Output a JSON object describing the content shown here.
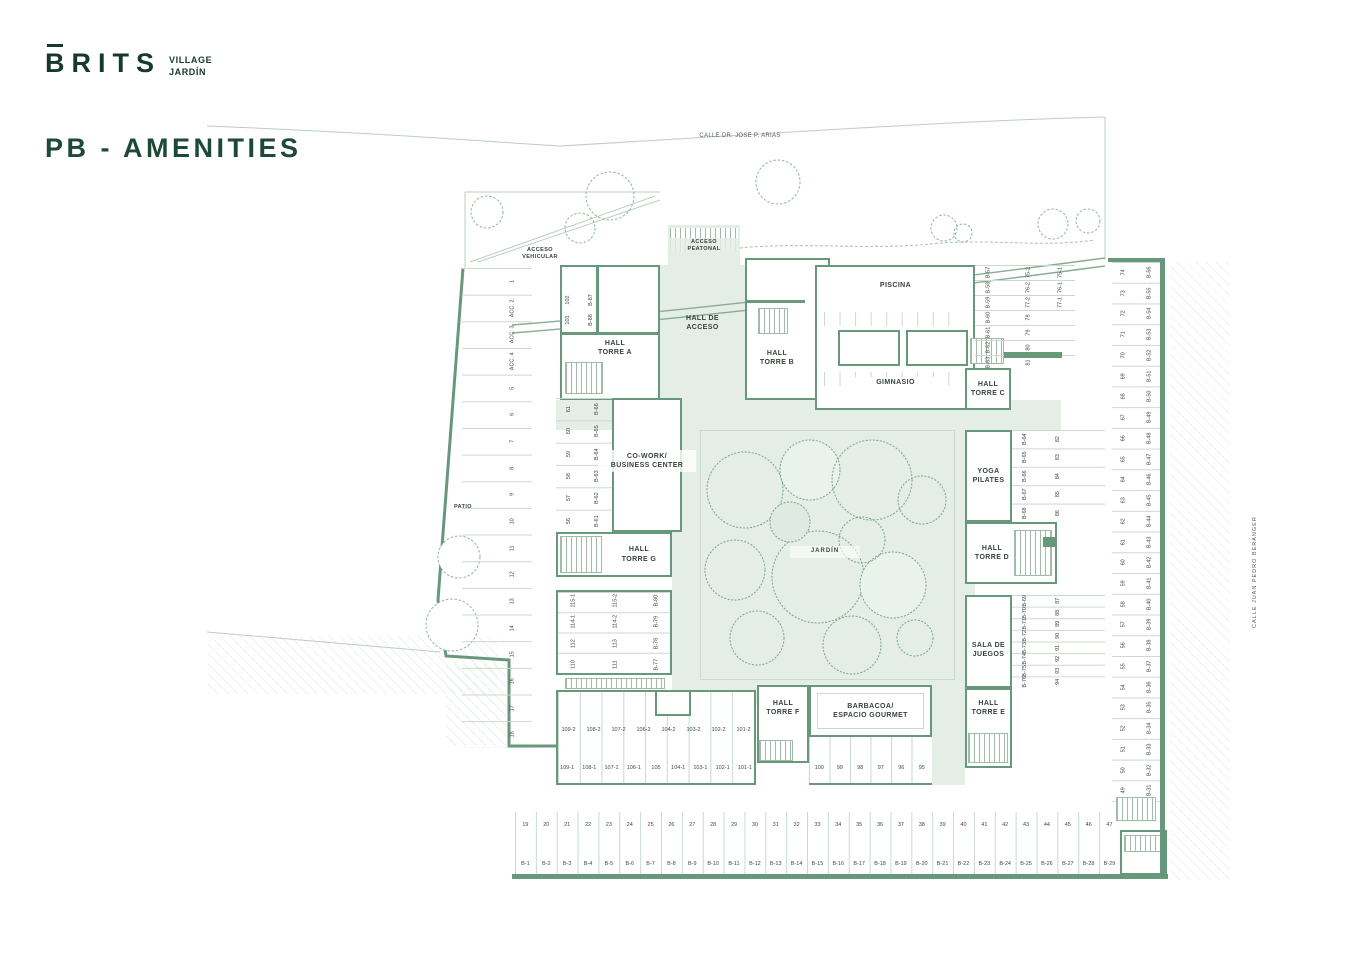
{
  "brand": {
    "logo": "BRITS",
    "sub_line1": "VILLAGE",
    "sub_line2": "JARDÍN"
  },
  "title": "PB - AMENITIES",
  "streets": {
    "top": "CALLE DR. JOSE P. ARIAS",
    "right": "CALLE JUAN PEDRO BERANGER"
  },
  "access": {
    "vehicular": "ACCESO\nVEHICULAR",
    "peatonal": "ACCESO\nPEATONAL"
  },
  "rooms": {
    "hall_acceso": "HALL DE\nACCESO",
    "torre_a": "HALL\nTORRE A",
    "torre_b": "HALL\nTORRE B",
    "piscina": "PISCINA",
    "gimnasio": "GIMNASIO",
    "torre_c": "HALL\nTORRE C",
    "cowork": "CO-WORK/\nBUSINESS CENTER",
    "torre_g": "HALL\nTORRE G",
    "jardin": "JARDÍN",
    "yoga": "YOGA\nPILATES",
    "torre_d": "HALL\nTORRE D",
    "sala_juegos": "SALA DE\nJUEGOS",
    "torre_e": "HALL\nTORRE E",
    "torre_f": "HALL\nTORRE F",
    "barbacoa": "BARBACOA/\nESPACIO GOURMET",
    "patio": "PATIO"
  },
  "parking": {
    "left_numbers": [
      "1",
      "ACC. 2",
      "ACC. 3",
      "ACC. 4",
      "5",
      "6",
      "7",
      "8",
      "9",
      "10",
      "11",
      "12",
      "13",
      "14",
      "15",
      "16",
      "17",
      "18"
    ],
    "bottom_numbers": [
      "19",
      "20",
      "21",
      "22",
      "23",
      "24",
      "25",
      "26",
      "27",
      "28",
      "29",
      "30",
      "31",
      "32",
      "33",
      "34",
      "35",
      "36",
      "37",
      "38",
      "39",
      "40",
      "41",
      "42",
      "43",
      "44",
      "45",
      "46",
      "47"
    ],
    "bottom_codes": [
      "B-1",
      "B-2",
      "B-3",
      "B-4",
      "B-5",
      "B-6",
      "B-7",
      "B-8",
      "B-9",
      "B-10",
      "B-11",
      "B-12",
      "B-13",
      "B-14",
      "B-15",
      "B-16",
      "B-17",
      "B-18",
      "B-19",
      "B-20",
      "B-21",
      "B-22",
      "B-23",
      "B-24",
      "B-25",
      "B-26",
      "B-27",
      "B-28",
      "B-29"
    ],
    "right_numbers": [
      "74",
      "73",
      "72",
      "71",
      "70",
      "69",
      "68",
      "67",
      "66",
      "65",
      "64",
      "63",
      "62",
      "61",
      "60",
      "59",
      "58",
      "57",
      "56",
      "55",
      "54",
      "53",
      "52",
      "51",
      "50",
      "49",
      "48"
    ],
    "right_codes": [
      "B-56",
      "B-55",
      "B-54",
      "B-53",
      "B-52",
      "B-51",
      "B-50",
      "B-49",
      "B-48",
      "B-47",
      "B-46",
      "B-45",
      "B-44",
      "B-43",
      "B-42",
      "B-41",
      "B-40",
      "B-39",
      "B-38",
      "B-37",
      "B-36",
      "B-35",
      "B-34",
      "B-33",
      "B-32",
      "B-31",
      "B-30"
    ],
    "torre_a_codes_1": [
      "102",
      "101"
    ],
    "torre_a_codes_2": [
      "B-87",
      "B-88"
    ],
    "topright_col_a": [
      "B-57",
      "B-58",
      "B-59",
      "B-60",
      "B-61",
      "B-62",
      "B-63"
    ],
    "topright_col_b": [
      "75-2",
      "76-2",
      "77-2",
      "78",
      "79",
      "80",
      "81"
    ],
    "topright_col_c": [
      "75-1",
      "76-1",
      "77-1"
    ],
    "cowork_numbers": [
      "61",
      "60",
      "59",
      "58",
      "57",
      "56"
    ],
    "cowork_codes": [
      "B-66",
      "B-65",
      "B-64",
      "B-63",
      "B-62",
      "B-61"
    ],
    "yoga_codes": [
      "B-64",
      "B-65",
      "B-66",
      "B-67",
      "B-68"
    ],
    "yoga_numbers": [
      "82",
      "83",
      "84",
      "85",
      "86"
    ],
    "juegos_codes": [
      "B-69",
      "B-70",
      "B-71",
      "B-72",
      "B-73",
      "B-74",
      "B-75",
      "B-76"
    ],
    "juegos_numbers": [
      "87",
      "88",
      "89",
      "90",
      "91",
      "92",
      "93",
      "94"
    ],
    "midleft_col_a": [
      "115-1",
      "114-1",
      "112",
      "110"
    ],
    "midleft_col_b": [
      "115-2",
      "114-2",
      "113",
      "111"
    ],
    "midleft_col_c": [
      "B-80",
      "B-79",
      "B-78",
      "B-77"
    ],
    "bottomleft_row_top": [
      "109-2",
      "108-2",
      "107-2",
      "106-2",
      "104-2",
      "103-2",
      "102-2",
      "101-2"
    ],
    "bottomleft_row_bottom": [
      "109-1",
      "108-1",
      "107-1",
      "106-1",
      "105",
      "104-1",
      "103-1",
      "102-1",
      "101-1"
    ],
    "bottom_center": [
      "100",
      "99",
      "98",
      "97",
      "96",
      "95"
    ]
  },
  "colors": {
    "wall": "#67987b",
    "fill": "#e4ede6",
    "brand": "#15392a",
    "line": "#c9d9cd"
  }
}
